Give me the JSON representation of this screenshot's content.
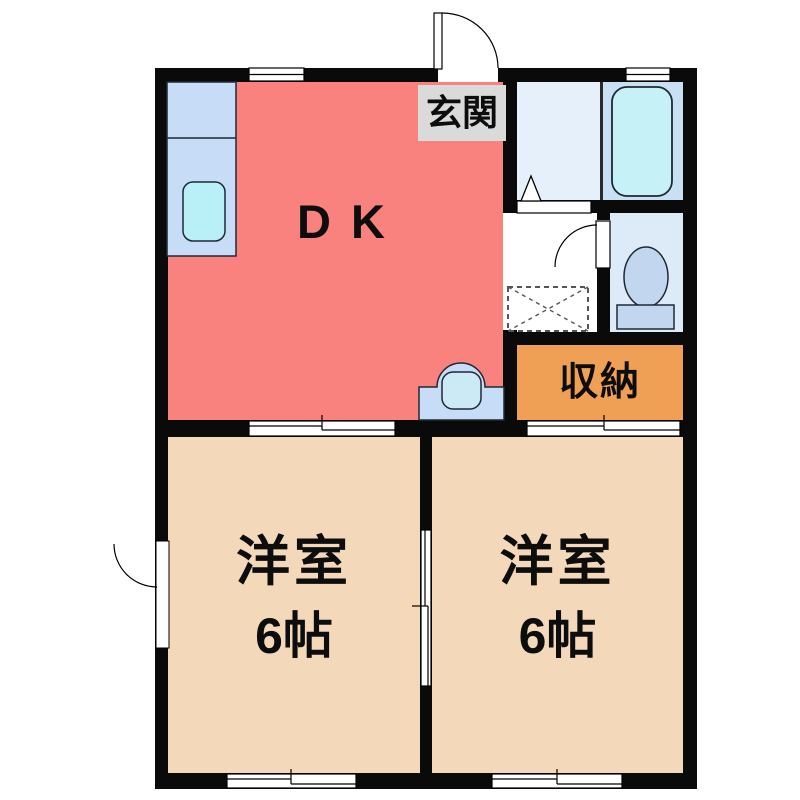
{
  "plan_title": "apartment-floor-plan",
  "labels": {
    "genkan": "玄関",
    "dk": "DK",
    "storage": "収納",
    "room_left_name": "洋室",
    "room_left_size": "6帖",
    "room_right_name": "洋室",
    "room_right_size": "6帖"
  },
  "colors": {
    "background": "#ffffff",
    "wall": "#0a0a0a",
    "partition": "#2a2a2a",
    "dk": "#F9827E",
    "bedroom_left": "#F4D8BA",
    "bedroom_right": "#F4D8BA",
    "storage": "#F0A055",
    "genkan_label_bg": "#DADADA",
    "hallway": "#FFFFFF",
    "washroom": "#E6F0FB",
    "bathroom": "#C9DFF4",
    "bathtub": "#C5F1F7",
    "toilet_room": "#DDEAF8",
    "toilet_fixture": "#C2D6F0",
    "kitchen_counter": "#C7DCF6",
    "kitchen_sink": "#B9EFF7",
    "vanity": "#C7DCF6",
    "vanity_bowl": "#CBEAF5",
    "door_symbol": "#FFFFFF",
    "outline": "#1F2933"
  },
  "fixtures": {
    "kitchen_counter": "kitchen-counter-with-sink",
    "vanity": "wash-basin-unit",
    "bathtub": "bathtub",
    "toilet": "toilet-bowl-with-tank",
    "washing_machine_space": "washing-machine-space-dashed-box",
    "entrance_door": "hinged-door-swing-out",
    "toilet_door": "hinged-door-swing-into-hallway",
    "left_wall_door": "hinged-door-left-wall",
    "washroom_door": "folding-door-triangle-marker",
    "sliding_doors": [
      "dk-to-left-room",
      "storage-to-right-room",
      "between-rooms"
    ],
    "windows": [
      "top-dk-window",
      "top-bathroom-window",
      "bottom-left-room-window",
      "bottom-right-room-window"
    ]
  }
}
